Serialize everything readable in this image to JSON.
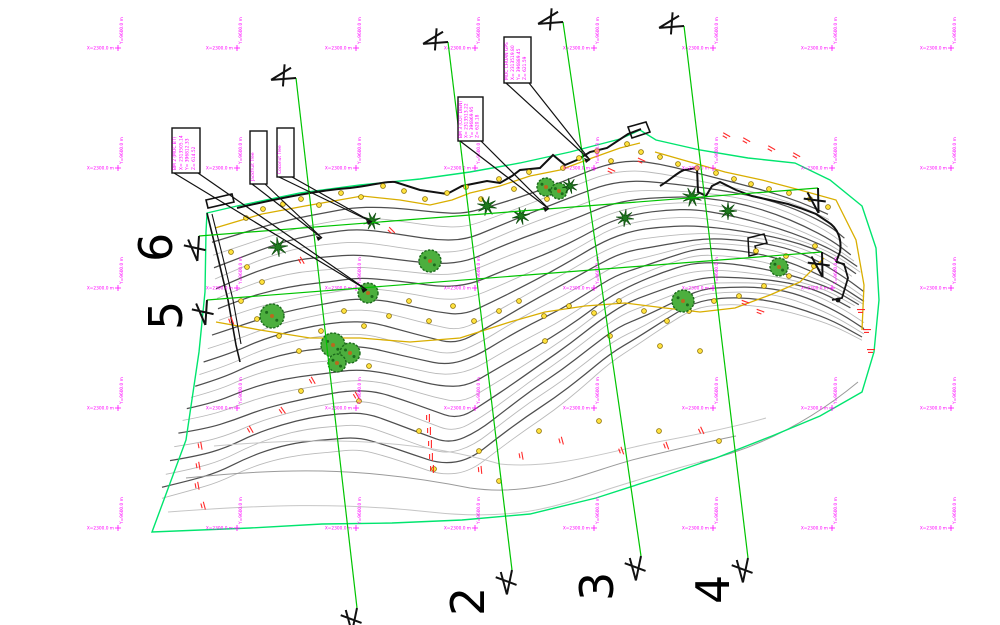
{
  "drawing": {
    "name": "topographic-survey-plan",
    "background": "#ffffff"
  },
  "colors": {
    "grid_label": "#ff00ff",
    "section_line": "#00c400",
    "boundary": "#00e56e",
    "contour_dark": "#4f4f4f",
    "contour_light": "#b9b9b9",
    "contour_faint": "#c6c6c6",
    "yellow_line": "#d9ae00",
    "spot_fill": "#ffe23e",
    "spot_stroke": "#8a6d00",
    "red_tick": "#ff2a2a",
    "tree_fill": "#4caf3e",
    "tree_dark": "#1c6b1c",
    "palm": "#1e7a1e",
    "ink": "#111111"
  },
  "grid": {
    "cols_x": [
      118,
      237,
      356,
      475,
      594,
      713,
      832,
      951
    ],
    "rows_y": [
      48,
      168,
      288,
      408,
      528
    ],
    "x_label": "X=2300.0 m",
    "y_label": "Y=9600.0 m"
  },
  "sections": [
    {
      "label": "6",
      "x1": 199,
      "y1": 236,
      "x2": 818,
      "y2": 188,
      "label_x": 172,
      "label_y": 262,
      "m1_rot": -70,
      "m2_rot": -75
    },
    {
      "label": "5",
      "x1": 207,
      "y1": 300,
      "x2": 822,
      "y2": 252,
      "label_x": 182,
      "label_y": 330,
      "m1_rot": -70,
      "m2_rot": -75
    },
    {
      "label": "",
      "x1": 296,
      "y1": 78,
      "x2": 357,
      "y2": 608,
      "label_x": 318,
      "label_y": 640,
      "m1_rot": 12,
      "m2_rot": -62
    },
    {
      "label": "2",
      "x1": 448,
      "y1": 42,
      "x2": 512,
      "y2": 570,
      "label_x": 484,
      "label_y": 616,
      "m1_rot": 12,
      "m2_rot": -62
    },
    {
      "label": "3",
      "x1": 563,
      "y1": 22,
      "x2": 641,
      "y2": 556,
      "label_x": 613,
      "label_y": 601,
      "m1_rot": 12,
      "m2_rot": -62
    },
    {
      "label": "4",
      "x1": 684,
      "y1": 26,
      "x2": 748,
      "y2": 558,
      "label_x": 729,
      "label_y": 604,
      "m1_rot": 12,
      "m2_rot": -62
    }
  ],
  "callouts": [
    {
      "x": 172,
      "y": 128,
      "w": 28,
      "h": 45,
      "tip": [
        367,
        290
      ],
      "lines": [
        "BM 2 (MOC BT)",
        "X= 2313505.14",
        "Y= 396812.33",
        "Z= 614.52"
      ]
    },
    {
      "x": 250,
      "y": 131,
      "w": 17,
      "h": 53,
      "tip": [
        322,
        238
      ],
      "lines": [
        "Jackfruit Tree"
      ]
    },
    {
      "x": 277,
      "y": 128,
      "w": 17,
      "h": 49,
      "tip": [
        372,
        222
      ],
      "lines": [
        "Coconut Tree"
      ]
    },
    {
      "x": 458,
      "y": 97,
      "w": 25,
      "h": 44,
      "tip": [
        549,
        209
      ],
      "lines": [
        "BM 3 (COT DIEN)",
        "X= 2313513.22",
        "Y= 396869.95",
        "Z= 620.18"
      ]
    },
    {
      "x": 504,
      "y": 37,
      "w": 27,
      "h": 46,
      "tip": [
        590,
        160
      ],
      "lines": [
        "MOC CHUAN GPS",
        "X= 2313519.80",
        "Y= 396889.45",
        "Z= 621.59"
      ]
    }
  ],
  "trees": {
    "canopy": [
      [
        430,
        261,
        11
      ],
      [
        368,
        293,
        10
      ],
      [
        272,
        316,
        12
      ],
      [
        333,
        345,
        12
      ],
      [
        350,
        353,
        10
      ],
      [
        337,
        363,
        9
      ],
      [
        546,
        187,
        9
      ],
      [
        559,
        191,
        8
      ],
      [
        683,
        301,
        11
      ],
      [
        779,
        267,
        9
      ]
    ],
    "palm": [
      [
        278,
        247,
        10
      ],
      [
        372,
        221,
        9
      ],
      [
        487,
        206,
        10
      ],
      [
        521,
        216,
        9
      ],
      [
        625,
        218,
        9
      ],
      [
        692,
        197,
        10
      ],
      [
        728,
        211,
        9
      ],
      [
        570,
        186,
        8
      ]
    ]
  },
  "spot_points": [
    [
      246,
      218
    ],
    [
      263,
      209
    ],
    [
      283,
      204
    ],
    [
      301,
      199
    ],
    [
      319,
      205
    ],
    [
      341,
      193
    ],
    [
      361,
      197
    ],
    [
      383,
      186
    ],
    [
      404,
      191
    ],
    [
      425,
      199
    ],
    [
      447,
      193
    ],
    [
      466,
      187
    ],
    [
      481,
      199
    ],
    [
      499,
      179
    ],
    [
      514,
      189
    ],
    [
      529,
      172
    ],
    [
      547,
      199
    ],
    [
      563,
      168
    ],
    [
      579,
      158
    ],
    [
      597,
      151
    ],
    [
      611,
      161
    ],
    [
      627,
      144
    ],
    [
      641,
      152
    ],
    [
      660,
      157
    ],
    [
      678,
      164
    ],
    [
      697,
      168
    ],
    [
      716,
      173
    ],
    [
      734,
      179
    ],
    [
      751,
      184
    ],
    [
      769,
      189
    ],
    [
      789,
      193
    ],
    [
      810,
      199
    ],
    [
      828,
      207
    ],
    [
      231,
      252
    ],
    [
      247,
      267
    ],
    [
      262,
      282
    ],
    [
      241,
      301
    ],
    [
      257,
      319
    ],
    [
      279,
      336
    ],
    [
      299,
      351
    ],
    [
      321,
      331
    ],
    [
      344,
      311
    ],
    [
      364,
      326
    ],
    [
      389,
      316
    ],
    [
      409,
      301
    ],
    [
      429,
      321
    ],
    [
      453,
      306
    ],
    [
      474,
      321
    ],
    [
      499,
      311
    ],
    [
      519,
      301
    ],
    [
      544,
      316
    ],
    [
      569,
      306
    ],
    [
      594,
      313
    ],
    [
      619,
      301
    ],
    [
      644,
      311
    ],
    [
      667,
      321
    ],
    [
      689,
      311
    ],
    [
      714,
      301
    ],
    [
      739,
      296
    ],
    [
      764,
      286
    ],
    [
      789,
      276
    ],
    [
      814,
      266
    ],
    [
      301,
      391
    ],
    [
      359,
      401
    ],
    [
      419,
      431
    ],
    [
      479,
      451
    ],
    [
      539,
      431
    ],
    [
      599,
      421
    ],
    [
      659,
      431
    ],
    [
      719,
      441
    ],
    [
      499,
      481
    ],
    [
      434,
      469
    ],
    [
      369,
      366
    ],
    [
      545,
      341
    ],
    [
      610,
      336
    ],
    [
      660,
      346
    ],
    [
      700,
      351
    ],
    [
      756,
      251
    ],
    [
      786,
      256
    ],
    [
      815,
      246
    ]
  ],
  "red_ticks": [
    [
      200,
      446,
      80
    ],
    [
      198,
      466,
      80
    ],
    [
      197,
      486,
      80
    ],
    [
      203,
      506,
      75
    ],
    [
      428,
      418,
      90
    ],
    [
      429,
      431,
      90
    ],
    [
      430,
      444,
      90
    ],
    [
      431,
      457,
      90
    ],
    [
      432,
      469,
      90
    ],
    [
      250,
      430,
      60
    ],
    [
      282,
      411,
      55
    ],
    [
      312,
      381,
      60
    ],
    [
      356,
      396,
      60
    ],
    [
      480,
      470,
      85
    ],
    [
      521,
      456,
      80
    ],
    [
      561,
      441,
      75
    ],
    [
      621,
      451,
      70
    ],
    [
      666,
      446,
      70
    ],
    [
      701,
      431,
      65
    ],
    [
      726,
      136,
      30
    ],
    [
      746,
      141,
      30
    ],
    [
      771,
      149,
      30
    ],
    [
      796,
      156,
      30
    ],
    [
      861,
      311,
      0
    ],
    [
      867,
      331,
      0
    ],
    [
      871,
      351,
      0
    ],
    [
      641,
      161,
      25
    ],
    [
      611,
      171,
      25
    ],
    [
      391,
      231,
      45
    ],
    [
      301,
      261,
      60
    ],
    [
      231,
      321,
      70
    ],
    [
      745,
      303,
      20
    ],
    [
      760,
      312,
      20
    ]
  ]
}
